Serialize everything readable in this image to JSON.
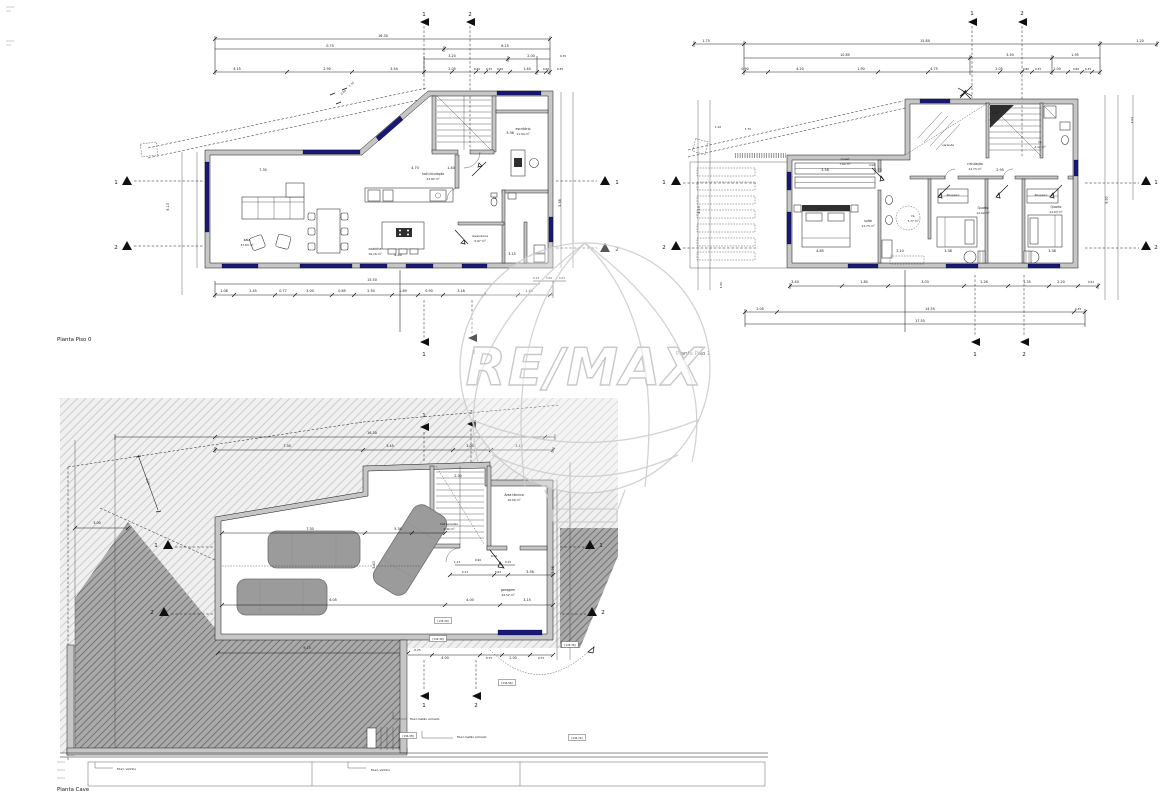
{
  "watermark": {
    "brand": "RE/MAX",
    "color": "#cbcbcb"
  },
  "piso0": {
    "title": "Planta Piso 0",
    "dims": [
      {
        "t": "16.30",
        "x": 383,
        "y": 37
      },
      {
        "t": "0.75",
        "x": 330,
        "y": 47
      },
      {
        "t": "6.15",
        "x": 505,
        "y": 47
      },
      {
        "t": "3.20",
        "x": 452,
        "y": 57
      },
      {
        "t": "2.00",
        "x": 531,
        "y": 57
      },
      {
        "t": "0.35",
        "x": 563,
        "y": 57,
        "s": 2.8
      },
      {
        "t": "4.15",
        "x": 237,
        "y": 70
      },
      {
        "t": "2.90",
        "x": 327,
        "y": 70
      },
      {
        "t": "3.54",
        "x": 394,
        "y": 70
      },
      {
        "t": "2.05",
        "x": 452,
        "y": 70
      },
      {
        "t": "0.60",
        "x": 477,
        "y": 70,
        "s": 2.8
      },
      {
        "t": "0.35",
        "x": 489,
        "y": 70,
        "s": 2.8
      },
      {
        "t": "0.60",
        "x": 500,
        "y": 70,
        "s": 2.8
      },
      {
        "t": "1.40",
        "x": 527,
        "y": 70
      },
      {
        "t": "0.60",
        "x": 546,
        "y": 70,
        "s": 2.8
      },
      {
        "t": "0.35",
        "x": 560,
        "y": 70,
        "s": 2.8
      },
      {
        "t": "1.14",
        "x": 352,
        "y": 85,
        "r": -41,
        "s": 2.8
      },
      {
        "t": "0.94",
        "x": 344,
        "y": 93,
        "r": -41,
        "s": 2.8
      },
      {
        "t": "15.50",
        "x": 372,
        "y": 281
      },
      {
        "t": "1.08",
        "x": 224,
        "y": 292
      },
      {
        "t": "2.45",
        "x": 253,
        "y": 292
      },
      {
        "t": "0.77",
        "x": 283,
        "y": 292
      },
      {
        "t": "3.00",
        "x": 310,
        "y": 292
      },
      {
        "t": "0.85",
        "x": 342,
        "y": 292
      },
      {
        "t": "2.50",
        "x": 371,
        "y": 292
      },
      {
        "t": "1.69",
        "x": 403,
        "y": 292
      },
      {
        "t": "0.90",
        "x": 429,
        "y": 292
      },
      {
        "t": "3.16",
        "x": 461,
        "y": 292
      },
      {
        "t": "1.40",
        "x": 529,
        "y": 292
      },
      {
        "t": "0.25",
        "x": 536,
        "y": 279,
        "s": 2.8
      },
      {
        "t": "3.60",
        "x": 549,
        "y": 279,
        "s": 2.8
      },
      {
        "t": "0.52",
        "x": 562,
        "y": 279,
        "s": 2.8
      },
      {
        "t": "9.13",
        "x": 169,
        "y": 207,
        "r": -90
      },
      {
        "t": "5.58",
        "x": 561,
        "y": 203,
        "r": -90
      },
      {
        "t": "7.30",
        "x": 263,
        "y": 171
      },
      {
        "t": "4.70",
        "x": 415,
        "y": 169
      },
      {
        "t": "1.40",
        "x": 451,
        "y": 169
      },
      {
        "t": "4.40",
        "x": 398,
        "y": 256
      },
      {
        "t": "3.15",
        "x": 512,
        "y": 255
      },
      {
        "t": "3.36",
        "x": 510,
        "y": 134
      }
    ],
    "rooms": [
      {
        "t": "sala",
        "x": 247,
        "y": 241,
        "s": 3.4,
        "n": "room-label"
      },
      {
        "t": "37.63 m²",
        "x": 247,
        "y": 246,
        "s": 2.9,
        "n": "room-area"
      },
      {
        "t": "hall circulação",
        "x": 433,
        "y": 175,
        "s": 3.1,
        "n": "room-label"
      },
      {
        "t": "23.92 m²",
        "x": 433,
        "y": 180,
        "s": 2.9,
        "n": "room-area"
      },
      {
        "t": "cozinha",
        "x": 375,
        "y": 250,
        "s": 3.4,
        "n": "room-label"
      },
      {
        "t": "16.16 m²",
        "x": 375,
        "y": 255,
        "s": 2.9,
        "n": "room-area"
      },
      {
        "t": "escritório",
        "x": 523,
        "y": 130,
        "s": 3.2,
        "n": "room-label"
      },
      {
        "t": "11.94 m²",
        "x": 523,
        "y": 135,
        "s": 2.9,
        "n": "room-area"
      },
      {
        "t": "lavandaria",
        "x": 480,
        "y": 237,
        "s": 3.0,
        "n": "room-label"
      },
      {
        "t": "5.67 m²",
        "x": 480,
        "y": 242,
        "s": 2.9,
        "n": "room-area"
      },
      {
        "t": "I.S.",
        "x": 495,
        "y": 199,
        "s": 2.9,
        "n": "room-label"
      }
    ],
    "markers": [
      {
        "t": "1",
        "x": 424,
        "y": 16,
        "s": 5.5,
        "n": "section-marker"
      },
      {
        "t": "2",
        "x": 470,
        "y": 16,
        "s": 5.5,
        "n": "section-marker"
      },
      {
        "t": "1",
        "x": 116,
        "y": 184,
        "s": 5.5,
        "n": "section-marker"
      },
      {
        "t": "2",
        "x": 116,
        "y": 249,
        "s": 5.5,
        "n": "section-marker"
      },
      {
        "t": "1",
        "x": 617,
        "y": 184,
        "s": 5.5,
        "n": "section-marker"
      },
      {
        "t": "2",
        "x": 617,
        "y": 251,
        "s": 5.5,
        "n": "section-marker"
      },
      {
        "t": "1",
        "x": 424,
        "y": 356,
        "s": 5.5,
        "n": "section-marker"
      },
      {
        "t": "2",
        "x": 474,
        "y": 354,
        "s": 5.5,
        "n": "section-marker"
      }
    ]
  },
  "piso1": {
    "title": "Planta Piso 1",
    "dims": [
      {
        "t": "1.75",
        "x": 706,
        "y": 42
      },
      {
        "t": "15.80",
        "x": 925,
        "y": 42
      },
      {
        "t": "1.20",
        "x": 1140,
        "y": 42
      },
      {
        "t": "10.85",
        "x": 845,
        "y": 56
      },
      {
        "t": "3.50",
        "x": 1010,
        "y": 56
      },
      {
        "t": "1.95",
        "x": 1075,
        "y": 56
      },
      {
        "t": "0.90",
        "x": 745,
        "y": 70
      },
      {
        "t": "4.20",
        "x": 800,
        "y": 70
      },
      {
        "t": "1.90",
        "x": 861,
        "y": 70
      },
      {
        "t": "4.75",
        "x": 934,
        "y": 70
      },
      {
        "t": "2.05",
        "x": 999,
        "y": 70
      },
      {
        "t": "0.80",
        "x": 1026,
        "y": 70,
        "s": 2.8
      },
      {
        "t": "0.35",
        "x": 1038,
        "y": 70,
        "s": 2.8
      },
      {
        "t": "1.00",
        "x": 1057,
        "y": 70
      },
      {
        "t": "0.60",
        "x": 1076,
        "y": 70,
        "s": 2.8
      },
      {
        "t": "0.35",
        "x": 1088,
        "y": 70,
        "s": 2.8
      },
      {
        "t": "1.10",
        "x": 718,
        "y": 128,
        "s": 2.8
      },
      {
        "t": "1.75",
        "x": 748,
        "y": 130,
        "s": 2.8
      },
      {
        "t": "3.40",
        "x": 795,
        "y": 283
      },
      {
        "t": "1.80",
        "x": 864,
        "y": 283
      },
      {
        "t": "3.03",
        "x": 925,
        "y": 283
      },
      {
        "t": "2.26",
        "x": 984,
        "y": 283
      },
      {
        "t": "1.35",
        "x": 1027,
        "y": 283
      },
      {
        "t": "2.20",
        "x": 1061,
        "y": 283
      },
      {
        "t": "0.52",
        "x": 1091,
        "y": 283,
        "s": 2.8
      },
      {
        "t": "2.05",
        "x": 760,
        "y": 310
      },
      {
        "t": "14.55",
        "x": 930,
        "y": 310
      },
      {
        "t": "0.35",
        "x": 1078,
        "y": 310,
        "s": 2.8
      },
      {
        "t": "17.55",
        "x": 920,
        "y": 322
      },
      {
        "t": "4.13",
        "x": 700,
        "y": 210,
        "r": -90
      },
      {
        "t": "1.50",
        "x": 722,
        "y": 285,
        "r": -90,
        "s": 2.8
      },
      {
        "t": "9.97",
        "x": 1108,
        "y": 200,
        "r": -90
      },
      {
        "t": "1.02",
        "x": 1133,
        "y": 120,
        "r": -90,
        "s": 2.8
      },
      {
        "t": "3.58",
        "x": 825,
        "y": 171
      },
      {
        "t": "2.73",
        "x": 878,
        "y": 171
      },
      {
        "t": "2.95",
        "x": 1000,
        "y": 171
      },
      {
        "t": "1.00",
        "x": 995,
        "y": 114
      },
      {
        "t": "4.85",
        "x": 820,
        "y": 252
      },
      {
        "t": "2.10",
        "x": 900,
        "y": 252
      },
      {
        "t": "3.38",
        "x": 948,
        "y": 252
      },
      {
        "t": "3.38",
        "x": 1052,
        "y": 252
      }
    ],
    "rooms": [
      {
        "t": "closet",
        "x": 845,
        "y": 160,
        "s": 3.0,
        "n": "room-label"
      },
      {
        "t": "7.62 m²",
        "x": 845,
        "y": 165,
        "s": 2.9,
        "n": "room-area"
      },
      {
        "t": "hall",
        "x": 872,
        "y": 166,
        "s": 2.9,
        "n": "room-label"
      },
      {
        "t": "circulação",
        "x": 975,
        "y": 165,
        "s": 3.1,
        "n": "room-label"
      },
      {
        "t": "14.73 m²",
        "x": 975,
        "y": 170,
        "s": 2.9,
        "n": "room-area"
      },
      {
        "t": "suite",
        "x": 868,
        "y": 222,
        "s": 3.2,
        "n": "room-label"
      },
      {
        "t": "14.73 m²",
        "x": 868,
        "y": 227,
        "s": 2.9,
        "n": "room-area"
      },
      {
        "t": "I.S.",
        "x": 913,
        "y": 217,
        "s": 2.9,
        "n": "room-label"
      },
      {
        "t": "7.77 m²",
        "x": 913,
        "y": 222,
        "s": 2.9,
        "n": "room-area"
      },
      {
        "t": "Roupeiro",
        "x": 953,
        "y": 196,
        "s": 2.9,
        "n": "room-label"
      },
      {
        "t": "Roupeiro",
        "x": 1041,
        "y": 196,
        "s": 2.9,
        "n": "room-label"
      },
      {
        "t": "Quarto",
        "x": 983,
        "y": 209,
        "s": 3.2,
        "n": "room-label"
      },
      {
        "t": "12.02 m²",
        "x": 983,
        "y": 214,
        "s": 2.9,
        "n": "room-area"
      },
      {
        "t": "Quarto",
        "x": 1056,
        "y": 208,
        "s": 3.2,
        "n": "room-label"
      },
      {
        "t": "12.63 m²",
        "x": 1056,
        "y": 213,
        "s": 2.9,
        "n": "room-area"
      },
      {
        "t": "I.S.",
        "x": 1040,
        "y": 143,
        "s": 2.9,
        "n": "room-label"
      },
      {
        "t": "4.12 m²",
        "x": 1040,
        "y": 148,
        "s": 2.9,
        "n": "room-area"
      },
      {
        "t": "varanda",
        "x": 948,
        "y": 146,
        "s": 2.9,
        "n": "room-label"
      }
    ],
    "markers": [
      {
        "t": "1",
        "x": 972,
        "y": 15,
        "s": 5.5,
        "n": "section-marker"
      },
      {
        "t": "2",
        "x": 1022,
        "y": 15,
        "s": 5.5,
        "n": "section-marker"
      },
      {
        "t": "1",
        "x": 975,
        "y": 356,
        "s": 5.5,
        "n": "section-marker"
      },
      {
        "t": "2",
        "x": 1024,
        "y": 356,
        "s": 5.5,
        "n": "section-marker"
      },
      {
        "t": "1",
        "x": 664,
        "y": 184,
        "s": 5.5,
        "n": "section-marker"
      },
      {
        "t": "2",
        "x": 664,
        "y": 249,
        "s": 5.5,
        "n": "section-marker"
      },
      {
        "t": "1",
        "x": 1156,
        "y": 184,
        "s": 5.5,
        "n": "section-marker"
      },
      {
        "t": "2",
        "x": 1156,
        "y": 249,
        "s": 5.5,
        "n": "section-marker"
      }
    ]
  },
  "cave": {
    "title": "Planta Cave",
    "dims": [
      {
        "t": "16.30",
        "x": 372,
        "y": 434
      },
      {
        "t": "7.30",
        "x": 287,
        "y": 447
      },
      {
        "t": "3.45",
        "x": 390,
        "y": 447
      },
      {
        "t": "3.00",
        "x": 470,
        "y": 447
      },
      {
        "t": "3.13",
        "x": 519,
        "y": 447
      },
      {
        "t": "3.00",
        "x": 97,
        "y": 524
      },
      {
        "t": "6.10",
        "x": 147,
        "y": 482,
        "r": 65,
        "s": 3
      },
      {
        "t": "7.30",
        "x": 310,
        "y": 530
      },
      {
        "t": "5.30",
        "x": 398,
        "y": 530
      },
      {
        "t": "2.30",
        "x": 458,
        "y": 477
      },
      {
        "t": "1.13",
        "x": 457,
        "y": 563,
        "s": 2.8
      },
      {
        "t": "0.90",
        "x": 478,
        "y": 561,
        "s": 2.8
      },
      {
        "t": "0.40",
        "x": 494,
        "y": 557,
        "s": 2.8
      },
      {
        "t": "0.15",
        "x": 508,
        "y": 563,
        "s": 2.8
      },
      {
        "t": "2.13",
        "x": 465,
        "y": 573,
        "s": 2.8
      },
      {
        "t": "0.62",
        "x": 498,
        "y": 573,
        "s": 2.8
      },
      {
        "t": "3.56",
        "x": 530,
        "y": 573
      },
      {
        "t": "6.05",
        "x": 333,
        "y": 601
      },
      {
        "t": "4.00",
        "x": 470,
        "y": 601
      },
      {
        "t": "3.15",
        "x": 527,
        "y": 601
      },
      {
        "t": "5.40",
        "x": 375,
        "y": 565,
        "r": -90
      },
      {
        "t": "7.36",
        "x": 554,
        "y": 570,
        "r": -90
      },
      {
        "t": "9.15",
        "x": 307,
        "y": 649
      },
      {
        "t": "-0.25",
        "x": 417,
        "y": 651,
        "s": 2.8
      },
      {
        "t": "4.00",
        "x": 445,
        "y": 659
      },
      {
        "t": "0.75",
        "x": 489,
        "y": 659,
        "s": 2.8
      },
      {
        "t": "2.00",
        "x": 513,
        "y": 659
      },
      {
        "t": "0.75",
        "x": 541,
        "y": 659,
        "s": 2.8
      }
    ],
    "rooms": [
      {
        "t": "Área técnica",
        "x": 514,
        "y": 496,
        "s": 3.1,
        "n": "room-label"
      },
      {
        "t": "10.00 m²",
        "x": 514,
        "y": 501,
        "s": 2.9,
        "n": "room-area"
      },
      {
        "t": "hall escadas",
        "x": 449,
        "y": 525,
        "s": 2.9,
        "n": "room-label"
      },
      {
        "t": "4.42 m²",
        "x": 449,
        "y": 530,
        "s": 2.9,
        "n": "room-area"
      },
      {
        "t": "garagem",
        "x": 508,
        "y": 591,
        "s": 3.2,
        "n": "room-label"
      },
      {
        "t": "44.52 m²",
        "x": 508,
        "y": 596,
        "s": 2.9,
        "n": "room-area"
      },
      {
        "t": "Muro betão armado",
        "x": 410,
        "y": 720,
        "s": 3,
        "a": "start",
        "n": "wall-callout"
      },
      {
        "t": "Muro betão armado",
        "x": 457,
        "y": 738,
        "s": 3,
        "a": "start",
        "n": "wall-callout"
      },
      {
        "t": "Muro vizinho",
        "x": 117,
        "y": 770,
        "s": 3,
        "a": "start",
        "n": "wall-callout"
      },
      {
        "t": "Muro vizinho",
        "x": 371,
        "y": 771,
        "s": 3,
        "a": "start",
        "n": "wall-callout"
      }
    ],
    "levels": [
      {
        "t": "[134.40]",
        "x": 443,
        "y": 622,
        "s": 2.6,
        "n": "level-tag"
      },
      {
        "t": "[134.38]",
        "x": 438,
        "y": 640,
        "s": 2.6,
        "n": "level-tag"
      },
      {
        "t": "[134.36]",
        "x": 570,
        "y": 646,
        "s": 2.6,
        "n": "level-tag"
      },
      {
        "t": "[134.56]",
        "x": 507,
        "y": 684,
        "s": 2.6,
        "n": "level-tag"
      },
      {
        "t": "[134.38]",
        "x": 408,
        "y": 737,
        "s": 2.6,
        "n": "level-tag"
      },
      {
        "t": "[134.72]",
        "x": 577,
        "y": 739,
        "s": 2.6,
        "n": "level-tag"
      }
    ],
    "markers": [
      {
        "t": "1",
        "x": 424,
        "y": 417,
        "s": 5.5,
        "n": "section-marker"
      },
      {
        "t": "2",
        "x": 471,
        "y": 414,
        "s": 5.5,
        "n": "section-marker"
      },
      {
        "t": "1",
        "x": 424,
        "y": 707,
        "s": 5.5,
        "n": "section-marker"
      },
      {
        "t": "2",
        "x": 476,
        "y": 707,
        "s": 5.5,
        "n": "section-marker"
      },
      {
        "t": "1",
        "x": 156,
        "y": 547,
        "s": 5.5,
        "n": "section-marker"
      },
      {
        "t": "2",
        "x": 152,
        "y": 614,
        "s": 5.5,
        "n": "section-marker"
      },
      {
        "t": "1",
        "x": 601,
        "y": 547,
        "s": 5.5,
        "n": "section-marker"
      },
      {
        "t": "2",
        "x": 603,
        "y": 614,
        "s": 5.5,
        "n": "section-marker"
      }
    ]
  }
}
